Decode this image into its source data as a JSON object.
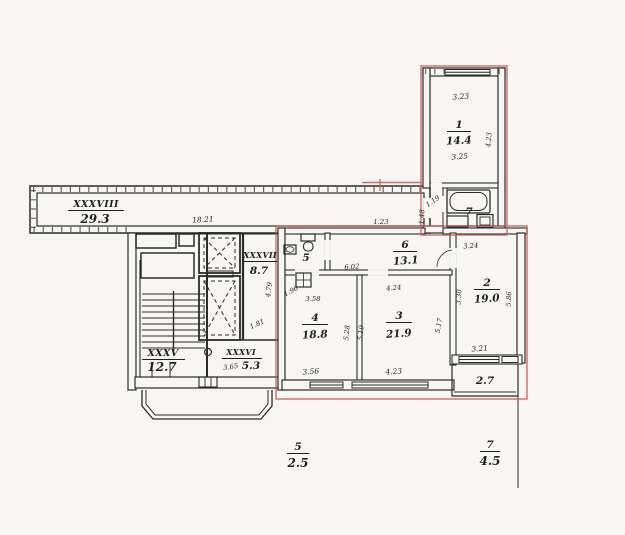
{
  "colors": {
    "paper": "#f7f6f3",
    "ink": "#2b2b2b",
    "apartment_outline": "#bf5a50"
  },
  "plan": {
    "corridor": {
      "numeral": "XXXVIII",
      "area": "29.3",
      "dim_length": "18.21",
      "dim_end": "1.23"
    },
    "staircase": {
      "numeral": "XXXV",
      "area": "12.7"
    },
    "lift_room": {
      "numeral": "XXXVII",
      "area": "8.7",
      "dim_depth": "4.79",
      "dim_door": "1.81"
    },
    "vestibule": {
      "numeral": "XXXVI",
      "area": "5.3",
      "dim_width": "3.65"
    },
    "room1": {
      "number": "1",
      "area": "14.4",
      "dim_top": "3.23",
      "dim_inner": "3.25",
      "dim_side": "4.23"
    },
    "bathroom": {
      "number": "7",
      "dim_hall": "1.19",
      "dim_side": "1.48"
    },
    "wc": {
      "number": "5"
    },
    "hall": {
      "number": "6",
      "area": "13.1",
      "dim_width": "6.02"
    },
    "room4": {
      "number": "4",
      "area": "18.8",
      "dim_top": "3.58",
      "dim_door": "1.96",
      "dim_bottom": "3.56",
      "dim_side": "5.28"
    },
    "room3": {
      "number": "3",
      "area": "21.9",
      "dim_top": "4.24",
      "dim_bottom": "4.23",
      "dim_left": "5.19",
      "dim_right": "5.17"
    },
    "room2": {
      "number": "2",
      "area": "19.0",
      "dim_top": "3.24",
      "dim_left": "3.30",
      "dim_right": "5.86",
      "dim_bottom": "3.21"
    },
    "balcony2": {
      "area": "2.7"
    },
    "balcony5": {
      "number": "5",
      "area": "2.5"
    },
    "balcony7": {
      "number": "7",
      "area": "4.5"
    }
  }
}
